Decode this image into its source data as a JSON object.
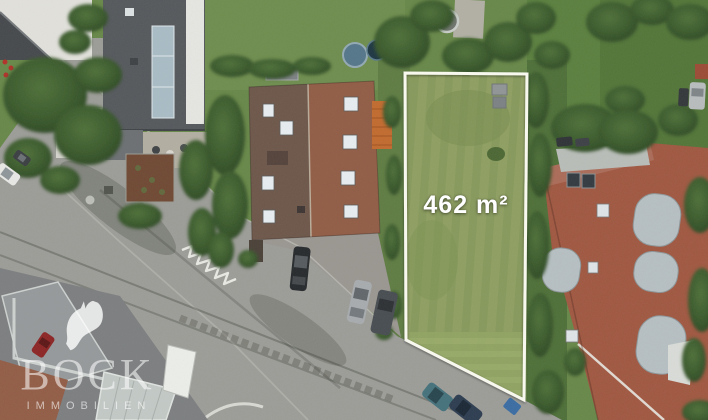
{
  "watermark": {
    "brand": "BOCK",
    "brand_subtitle": "IMMOBILIEN",
    "icon": "horse-head",
    "color_rgba": "rgba(255,255,255,0.55)"
  },
  "plot": {
    "area_label": "462 m²",
    "outline_color": "#fbfbf2"
  },
  "palette": {
    "lawn_green": "#678748",
    "plot_grass": "#87995c",
    "road_grey": "#9c9c98",
    "roof_terracotta": "#a05741",
    "roof_brown_left": "#6d564a",
    "roof_brown_right": "#915c45",
    "roof_dark_grey": "#54585c",
    "roof_orange": "#c26a2e",
    "tree_green": "#33512a"
  }
}
